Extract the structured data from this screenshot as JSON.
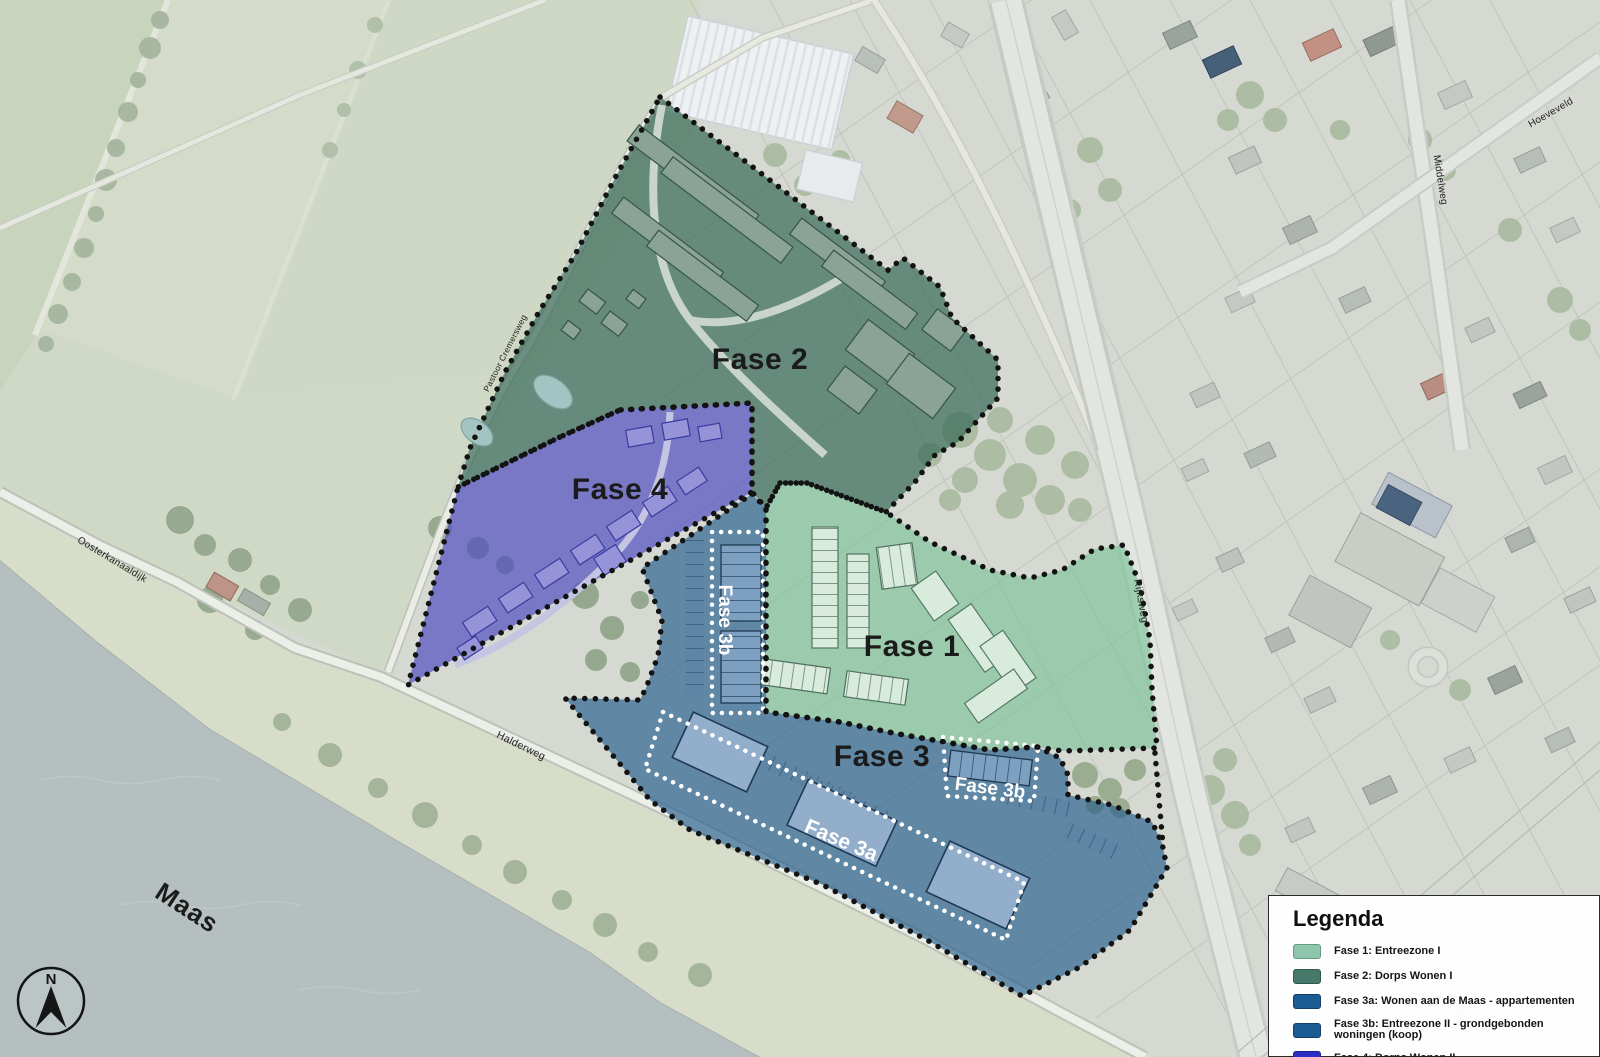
{
  "map": {
    "phase_labels": {
      "fase1": "Fase 1",
      "fase2": "Fase 2",
      "fase3": "Fase 3",
      "fase4": "Fase 4",
      "fase3a": "Fase 3a",
      "fase3b_strip": "Fase 3b",
      "fase3b_box": "Fase 3b"
    },
    "street_labels": {
      "maas": "Maas",
      "oosterkanaaldijk": "Oosterkanaaldijk",
      "halderweg": "Halderweg",
      "rijksweg": "Rijksweg",
      "middelweg": "Middelweg",
      "hoeveveld": "Hoeveveld",
      "site_road": "Pastoor Cremersweg"
    },
    "compass": {
      "north_label": "N"
    }
  },
  "overlay_colors": {
    "fase1": "rgba(125,195,152,0.66)",
    "fase2": "rgba(54,104,87,0.70)",
    "fase3": "rgba(40,96,140,0.68)",
    "fase4": "rgba(73,70,193,0.66)"
  },
  "legend": {
    "title": "Legenda",
    "items": [
      {
        "label": "Fase 1: Entreezone I",
        "color": "#8ec6ad",
        "border": "#5f9c82"
      },
      {
        "label": "Fase 2: Dorps Wonen I",
        "color": "#47796b",
        "border": "#2f5a4e"
      },
      {
        "label": "Fase 3a: Wonen aan de Maas - appartementen",
        "color": "#1c5c94",
        "border": "#123e68"
      },
      {
        "label": "Fase 3b: Entreezone II - grondgebonden woningen (koop)",
        "color": "#1c5c94",
        "border": "#123e68"
      },
      {
        "label": "Fase 4: Dorps Wonen II",
        "color": "#2b2fc4",
        "border": "#1b1e8f"
      }
    ]
  }
}
